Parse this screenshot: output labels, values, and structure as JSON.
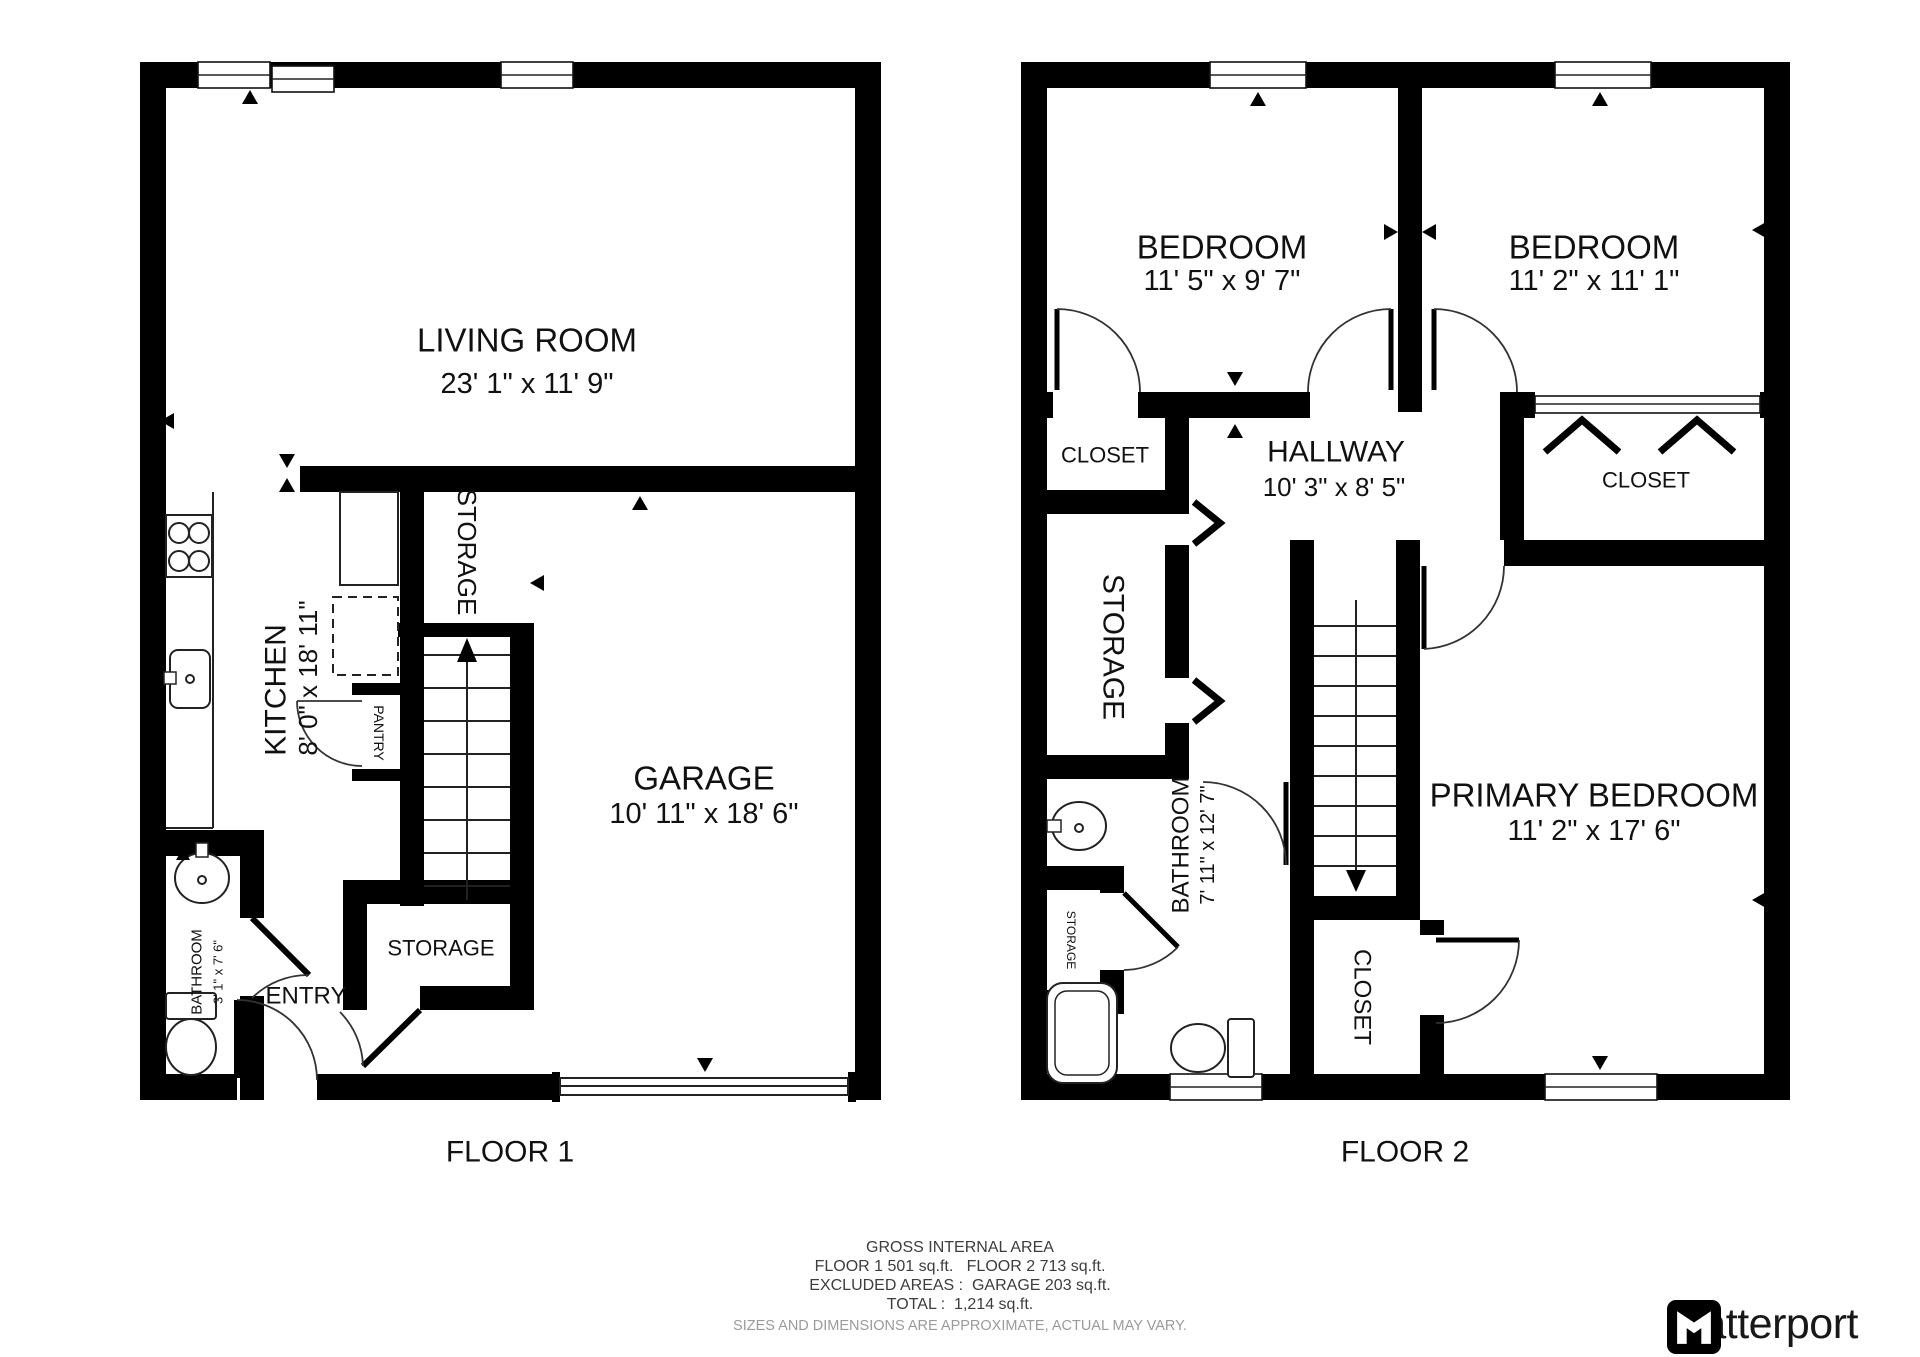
{
  "floors": {
    "floor1": {
      "label": "FLOOR 1",
      "living_room": {
        "name": "LIVING ROOM",
        "dims": "23' 1\" x 11' 9\""
      },
      "kitchen": {
        "name": "KITCHEN",
        "dims": "8' 0\" x 18' 11\""
      },
      "garage": {
        "name": "GARAGE",
        "dims": "10' 11\" x 18' 6\""
      },
      "storage_area": {
        "name": "STORAGE"
      },
      "storage_room": {
        "name": "STORAGE"
      },
      "pantry": {
        "name": "PANTRY"
      },
      "bathroom": {
        "name": "BATHROOM",
        "dims": "3' 1\" x 7' 6\""
      },
      "entry": {
        "name": "ENTRY"
      }
    },
    "floor2": {
      "label": "FLOOR 2",
      "bedroom_left": {
        "name": "BEDROOM",
        "dims": "11' 5\" x 9' 7\""
      },
      "bedroom_right": {
        "name": "BEDROOM",
        "dims": "11' 2\" x 11' 1\""
      },
      "closet_left": {
        "name": "CLOSET"
      },
      "hallway": {
        "name": "HALLWAY",
        "dims": "10' 3\" x 8' 5\""
      },
      "closet_right": {
        "name": "CLOSET"
      },
      "storage_left": {
        "name": "STORAGE"
      },
      "storage_small": {
        "name": "STORAGE"
      },
      "bathroom": {
        "name": "BATHROOM",
        "dims": "7' 11\" x 12' 7\""
      },
      "primary_bedroom": {
        "name": "PRIMARY BEDROOM",
        "dims": "11' 2\" x 17' 6\""
      },
      "closet_bottom": {
        "name": "CLOSET"
      }
    }
  },
  "footer": {
    "line1": "GROSS INTERNAL AREA",
    "line2": "FLOOR 1 501 sq.ft.   FLOOR 2 713 sq.ft.",
    "line3": "EXCLUDED AREAS :  GARAGE 203 sq.ft.",
    "line4": "TOTAL :  1,214 sq.ft.",
    "line5": "SIZES AND DIMENSIONS ARE APPROXIMATE, ACTUAL MAY VARY."
  },
  "brand": {
    "name": "Matterport"
  },
  "icons": {
    "stove": "four burner circles",
    "sink": "oval basin with faucet",
    "toilet": "tank and bowl",
    "bathtub": "double rounded rectangle",
    "stairs": "treads with direction arrow",
    "door": "quarter-arc swing",
    "bifold-door": "chevron",
    "sliding-door": "double line",
    "window": "triple line in wall",
    "logo": "matterport-m-mark"
  },
  "colors": {
    "wall": "#000000",
    "background": "#ffffff",
    "text": "#111111",
    "footer_text": "#3d3d3d",
    "disclaimer_text": "#9b9b9b"
  }
}
